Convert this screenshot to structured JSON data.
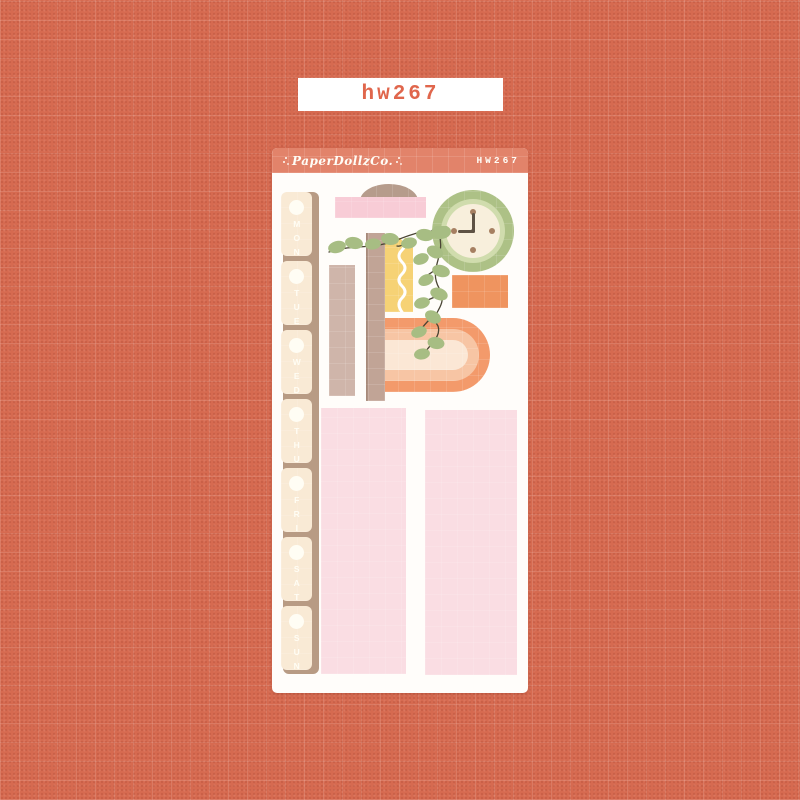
{
  "page": {
    "background_color": "#d66a50",
    "grid_pattern": "plaid grid of lighter lines, speckled texture"
  },
  "top_label": {
    "text": "hw267",
    "text_color": "#e0664c",
    "background_color": "#ffffff"
  },
  "sheet": {
    "background_color": "#fffdfa",
    "header": {
      "brand": "PaperDollzCo.",
      "sku": "HW267",
      "background_color": "#e2836a",
      "text_color": "#fffdf6"
    },
    "tabs": [
      "MON",
      "TUE",
      "WED",
      "THU",
      "FRI",
      "SAT",
      "SUN"
    ],
    "tab_style": {
      "base_color": "#f9ead5",
      "spine_color": "#b89b84",
      "text_color": "#fffdf4"
    },
    "stickers": [
      {
        "name": "dome-arch",
        "color": "#b69c8c"
      },
      {
        "name": "pink-washi-band",
        "color": "#f8ccd6"
      },
      {
        "name": "washi-strip-wide",
        "color": "#cfb5aa"
      },
      {
        "name": "washi-strip-narrow",
        "color": "#c1a496"
      },
      {
        "name": "yellow-notepad",
        "color": "#f6d275",
        "detail": "white wavy line"
      },
      {
        "name": "wall-clock",
        "colors": [
          "#adc186",
          "#d0dcad",
          "#f8efdc",
          "#a67f61",
          "#5e5244"
        ],
        "time": "9:00"
      },
      {
        "name": "orange-box",
        "color": "#ef945f"
      },
      {
        "name": "rounded-rainbow",
        "colors": [
          "#f39a6b",
          "#f7c5a4",
          "#fbe7d5"
        ]
      },
      {
        "name": "plant-vine",
        "leaf_color": "#a7bd83",
        "stem_color": "#4a4534"
      },
      {
        "name": "pink-full-box-left",
        "color": "#fadde3"
      },
      {
        "name": "pink-full-box-right",
        "color": "#fadde3"
      }
    ]
  }
}
